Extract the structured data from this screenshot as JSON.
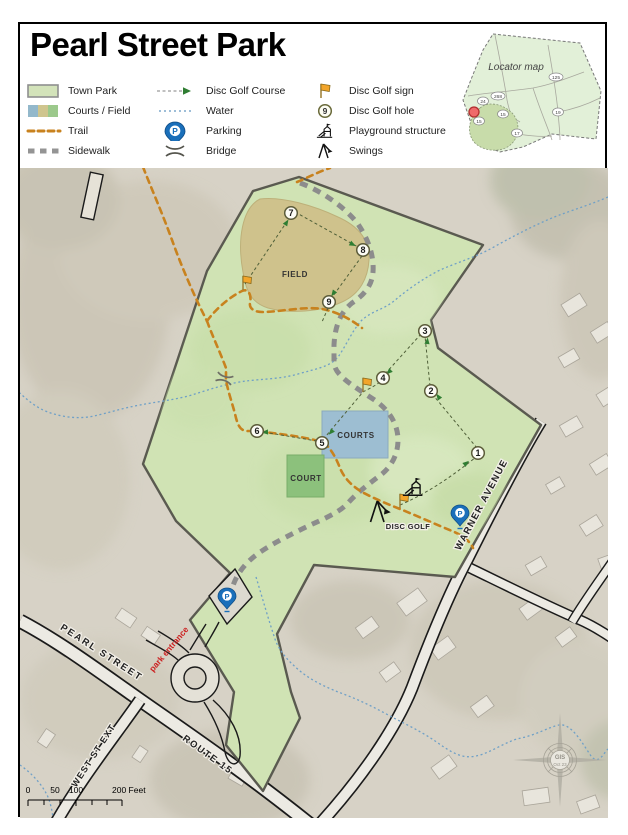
{
  "title": "Pearl Street Park",
  "legend": {
    "col1": [
      {
        "label": "Town Park"
      },
      {
        "label": "Courts / Field"
      },
      {
        "label": "Trail"
      },
      {
        "label": "Sidewalk"
      }
    ],
    "col2": [
      {
        "label": "Disc Golf Course"
      },
      {
        "label": "Water"
      },
      {
        "label": "Parking"
      },
      {
        "label": "Bridge"
      }
    ],
    "col3": [
      {
        "label": "Disc Golf sign"
      },
      {
        "label": "Disc Golf hole"
      },
      {
        "label": "Playground structure"
      },
      {
        "label": "Swings"
      }
    ],
    "hole_icon_number": "9"
  },
  "locator": {
    "title": "Locator map",
    "shields": [
      "24",
      "268",
      "15",
      "15",
      "125",
      "19",
      "17"
    ]
  },
  "map": {
    "areas": {
      "field": "FIELD",
      "courts": "COURTS",
      "court": "COURT",
      "disc_golf": "DISC GOLF"
    },
    "streets": {
      "pearl": "PEARL  STREET",
      "west_st_ext": "WEST  ST  EXT",
      "route_15": "ROUTE  15",
      "warner": "WARNER   AVENUE"
    },
    "entrance": "park entrance",
    "holes": [
      "1",
      "2",
      "3",
      "4",
      "5",
      "6",
      "7",
      "8",
      "9"
    ],
    "compass": {
      "center": "GIS",
      "date": "Oct 23"
    }
  },
  "scalebar": {
    "labels": [
      "0",
      "50",
      "100",
      "200 Feet"
    ]
  },
  "colors": {
    "town_park": "#d0e3b4",
    "field": "#cfc28c",
    "courts": "#9dbed2",
    "court": "#8cc17c",
    "trail": "#c8821e",
    "sidewalk": "#8c8c8c",
    "water": "#6fa0c7",
    "boundary": "#5a5a50",
    "entrance_text": "#cc2020",
    "parking_pin": "#1a6fba",
    "course_arrow": "#2f7d32"
  }
}
